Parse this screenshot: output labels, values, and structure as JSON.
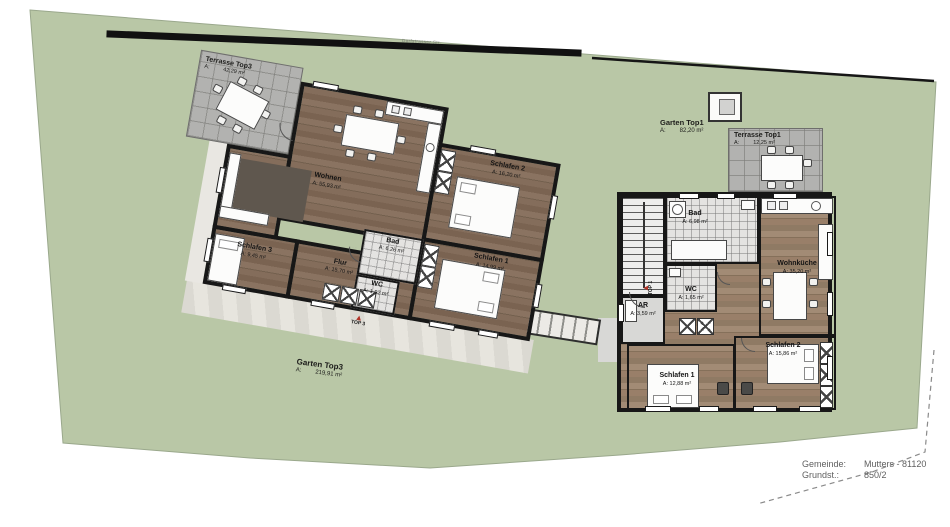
{
  "site": {
    "street_name": "Dorfstrasser Str.",
    "garten_top3_name": "Garten Top3",
    "garten_top3_area_label": "A:",
    "garten_top3_area": "219,91 m²",
    "garten_top1_name": "Garten Top1",
    "garten_top1_area_label": "A:",
    "garten_top1_area": "82,20 m²"
  },
  "top3": {
    "terrace_name": "Terrasse Top3",
    "terrace_area_label": "A:",
    "terrace_area": "42,29 m²",
    "marker": "TOP 3",
    "rooms": [
      {
        "name": "Wohnen",
        "area": "A: 55,93 m²"
      },
      {
        "name": "Schlafen 3",
        "area": "A: 9,45 m²"
      },
      {
        "name": "Flur",
        "area": "A: 15,70 m²"
      },
      {
        "name": "Bad",
        "area": "A: 6,26 m²"
      },
      {
        "name": "WC",
        "area": "A: 1,92 m²"
      },
      {
        "name": "Schlafen 1",
        "area": "A: 14,99 m²"
      },
      {
        "name": "Schlafen 2",
        "area": "A: 16,20 m²"
      }
    ]
  },
  "top1": {
    "terrace_name": "Terrasse Top1",
    "terrace_area_label": "A:",
    "terrace_area": "12,25 m²",
    "marker": "TOP 1",
    "rooms": [
      {
        "name": "Bad",
        "area": "A: 6,98 m²"
      },
      {
        "name": "Wohnküche",
        "area": "A: 35,20 m²"
      },
      {
        "name": "WC",
        "area": "A: 1,65 m²"
      },
      {
        "name": "AR",
        "area": "A: 3,59 m²"
      },
      {
        "name": "Schlafen 1",
        "area": "A: 12,88 m²"
      },
      {
        "name": "Schlafen 2",
        "area": "A: 15,86 m²"
      }
    ]
  },
  "footer": {
    "gemeinde_label": "Gemeinde:",
    "gemeinde_value": "Mutters - 81120",
    "grundst_label": "Grundst.:",
    "grundst_value": "850/2"
  },
  "colors": {
    "garden_green": "#b9c7a6",
    "terrace_gray": "#b2b2b0",
    "wood_dark": "#83705d",
    "wood_light": "#9c8874",
    "wall_black": "#171717",
    "marker_red": "#b23327"
  }
}
